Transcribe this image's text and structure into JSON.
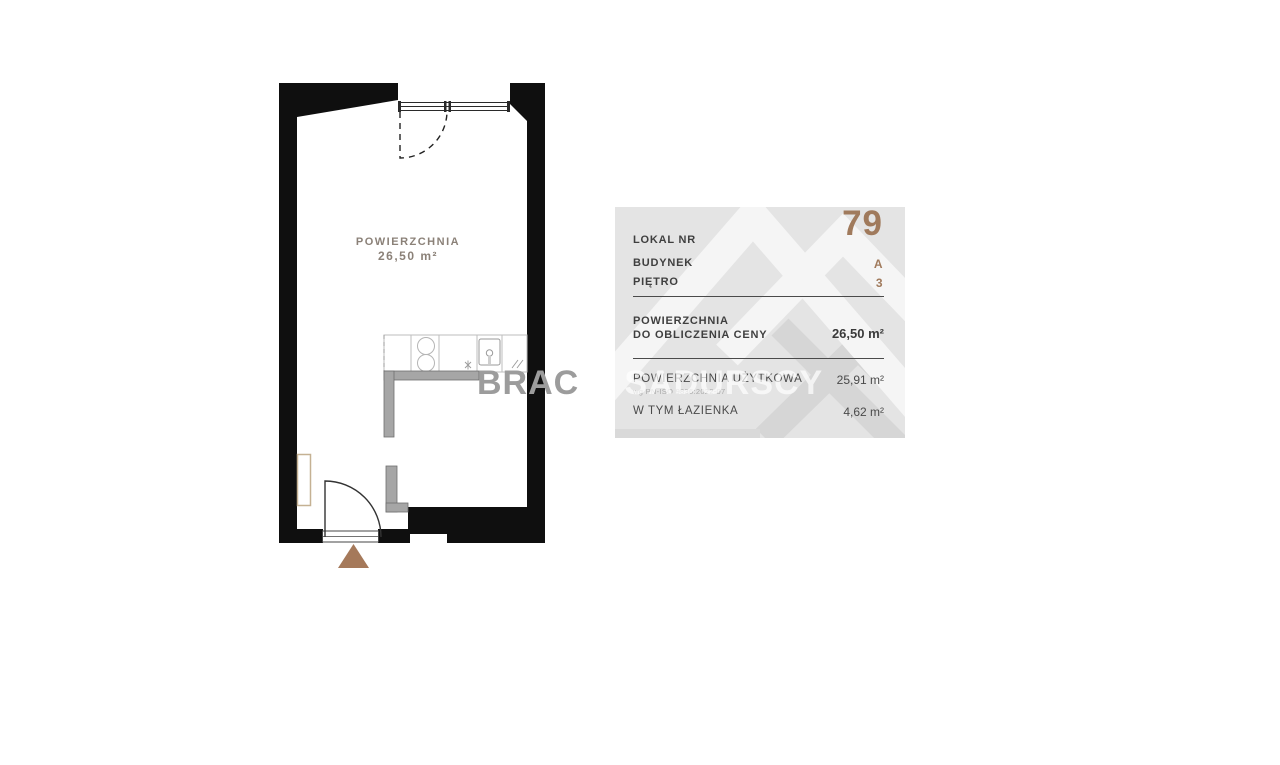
{
  "plan": {
    "room_area_label": "POWIERZCHNIA",
    "room_area_value": "26,50 m²"
  },
  "watermark": {
    "part_over_plan": "BRAC",
    "part_mid": "IA",
    "part_right": "SADURSCY"
  },
  "panel": {
    "unit": {
      "label": "LOKAL NR",
      "value": "79"
    },
    "building": {
      "label": "BUDYNEK",
      "value": "A"
    },
    "floor": {
      "label": "PIĘTRO",
      "value": "3"
    },
    "price_area": {
      "label_line1": "POWIERZCHNIA",
      "label_line2": "DO OBLICZENIA CENY",
      "value": "26,50 m²"
    },
    "usable_area": {
      "label": "POWIERZCHNIA UŻYTKOWA",
      "note": "wg PN-ISO 9836:2022-07",
      "value": "25,91 m²"
    },
    "bathroom_area": {
      "label": "W TYM ŁAZIENKA",
      "value": "4,62 m²"
    }
  },
  "colors": {
    "accent_brown": "#a07a5c",
    "entrance_arrow_brown": "#a5795a",
    "panel_background": "#e4e4e4",
    "wall_black": "#0f0f0f",
    "partition_gray": "#a6a6a6",
    "label_taupe": "#8b8178",
    "text_dark": "#3f3f3f"
  }
}
